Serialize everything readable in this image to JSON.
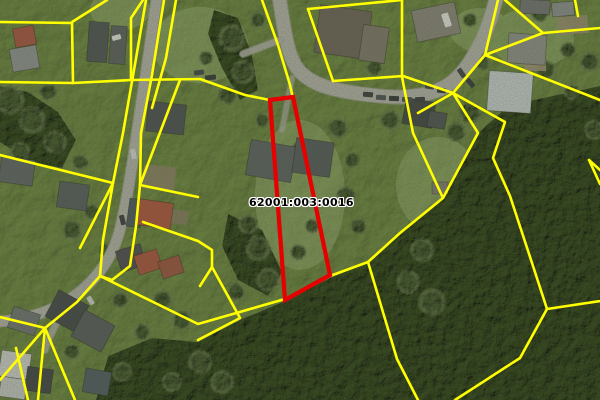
{
  "map": {
    "kind": "aerial-orthophoto-with-cadastral-overlay",
    "parcel_label": "62001:003:0016",
    "label_pos": {
      "x": 249,
      "y": 196
    },
    "colors": {
      "boundary_line": "#ffff00",
      "selected_parcel_outline": "#e60000",
      "label_text": "#000000",
      "label_halo": "#ffffff",
      "grass": "#8aa365",
      "grass_light": "#a3bb7c",
      "forest": "#4d6039",
      "road": "#b5b3ac",
      "road_edge": "#a19f98"
    },
    "selected_parcel_outline": [
      [
        270,
        100
      ],
      [
        293,
        97
      ],
      [
        330,
        275
      ],
      [
        285,
        300
      ]
    ],
    "selected_parcel_stroke_width": 4.2,
    "boundary_line_width": 2.6,
    "boundary_lines": [
      [
        [
          0,
          22
        ],
        [
          72,
          23
        ]
      ],
      [
        [
          107,
          0
        ],
        [
          72,
          22
        ]
      ],
      [
        [
          72,
          23
        ],
        [
          73,
          83
        ]
      ],
      [
        [
          0,
          82
        ],
        [
          73,
          83
        ],
        [
          131,
          80
        ],
        [
          200,
          79
        ],
        [
          245,
          95
        ],
        [
          270,
          100
        ]
      ],
      [
        [
          143,
          0
        ],
        [
          131,
          18
        ],
        [
          131,
          80
        ]
      ],
      [
        [
          164,
          0
        ],
        [
          152,
          75
        ],
        [
          141,
          133
        ],
        [
          140,
          185
        ]
      ],
      [
        [
          176,
          0
        ],
        [
          166,
          58
        ],
        [
          152,
          108
        ]
      ],
      [
        [
          262,
          0
        ],
        [
          278,
          45
        ],
        [
          290,
          85
        ],
        [
          293,
          98
        ]
      ],
      [
        [
          308,
          9
        ],
        [
          333,
          81
        ]
      ],
      [
        [
          308,
          9
        ],
        [
          402,
          0
        ]
      ],
      [
        [
          402,
          0
        ],
        [
          402,
          77
        ],
        [
          413,
          133
        ],
        [
          443,
          198
        ]
      ],
      [
        [
          333,
          81
        ],
        [
          403,
          76
        ],
        [
          453,
          93
        ]
      ],
      [
        [
          418,
          113
        ],
        [
          453,
          93
        ]
      ],
      [
        [
          453,
          93
        ],
        [
          485,
          55
        ],
        [
          498,
          0
        ]
      ],
      [
        [
          485,
          55
        ],
        [
          543,
          33
        ],
        [
          600,
          28
        ]
      ],
      [
        [
          505,
          0
        ],
        [
          543,
          33
        ]
      ],
      [
        [
          575,
          0
        ],
        [
          578,
          16
        ]
      ],
      [
        [
          485,
          55
        ],
        [
          600,
          100
        ]
      ],
      [
        [
          453,
          93
        ],
        [
          478,
          133
        ],
        [
          443,
          198
        ],
        [
          400,
          233
        ],
        [
          368,
          262
        ],
        [
          397,
          359
        ],
        [
          418,
          400
        ]
      ],
      [
        [
          453,
          93
        ],
        [
          505,
          122
        ],
        [
          493,
          158
        ],
        [
          510,
          196
        ],
        [
          533,
          266
        ],
        [
          547,
          309
        ]
      ],
      [
        [
          547,
          309
        ],
        [
          600,
          301
        ]
      ],
      [
        [
          547,
          309
        ],
        [
          520,
          358
        ],
        [
          455,
          400
        ]
      ],
      [
        [
          600,
          170
        ],
        [
          589,
          160
        ],
        [
          600,
          184
        ]
      ],
      [
        [
          140,
          185
        ],
        [
          180,
          80
        ]
      ],
      [
        [
          140,
          185
        ],
        [
          198,
          197
        ]
      ],
      [
        [
          143,
          222
        ],
        [
          198,
          241
        ],
        [
          212,
          250
        ],
        [
          212,
          267
        ]
      ],
      [
        [
          140,
          185
        ],
        [
          136,
          226
        ],
        [
          130,
          266
        ],
        [
          112,
          280
        ],
        [
          100,
          276
        ]
      ],
      [
        [
          113,
          183
        ],
        [
          0,
          155
        ]
      ],
      [
        [
          113,
          183
        ],
        [
          80,
          248
        ]
      ],
      [
        [
          146,
          0
        ],
        [
          134,
          70
        ],
        [
          123,
          133
        ],
        [
          113,
          183
        ],
        [
          103,
          240
        ],
        [
          100,
          276
        ]
      ],
      [
        [
          100,
          276
        ],
        [
          198,
          324
        ],
        [
          285,
          299
        ],
        [
          330,
          276
        ],
        [
          368,
          262
        ]
      ],
      [
        [
          212,
          267
        ],
        [
          240,
          318
        ],
        [
          198,
          340
        ]
      ],
      [
        [
          212,
          267
        ],
        [
          200,
          286
        ]
      ],
      [
        [
          45,
          328
        ],
        [
          0,
          317
        ]
      ],
      [
        [
          45,
          328
        ],
        [
          0,
          380
        ]
      ],
      [
        [
          45,
          328
        ],
        [
          38,
          400
        ]
      ],
      [
        [
          45,
          328
        ],
        [
          75,
          400
        ]
      ],
      [
        [
          45,
          328
        ],
        [
          77,
          302
        ],
        [
          100,
          276
        ]
      ],
      [
        [
          16,
          348
        ],
        [
          28,
          400
        ]
      ]
    ],
    "roads": [
      {
        "d": "M279,-4 C284,28 287,54 297,68 C310,85 332,90 362,94 C385,97 400,98 413,96 C447,93 463,77 479,46 C487,31 492,15 497,-4",
        "width": 13,
        "opacity": 1
      },
      {
        "d": "M157,-4 C151,40 145,80 139,118 C133,158 128,198 119,233 C111,261 92,287 62,304 C42,315 20,320 -4,322",
        "width": 10,
        "opacity": 1
      },
      {
        "d": "M88,282 C70,300 56,318 45,350",
        "width": 6,
        "opacity": 0.7
      },
      {
        "d": "M280,40 L243,54",
        "width": 6,
        "opacity": 0.8
      },
      {
        "d": "M292,78 L282,130",
        "width": 5,
        "opacity": 0.55
      }
    ],
    "forest_areas": [
      [
        [
          600,
          86
        ],
        [
          552,
          96
        ],
        [
          508,
          106
        ],
        [
          478,
          133
        ],
        [
          443,
          198
        ],
        [
          400,
          233
        ],
        [
          368,
          262
        ],
        [
          330,
          278
        ],
        [
          285,
          301
        ],
        [
          240,
          320
        ],
        [
          198,
          342
        ],
        [
          152,
          338
        ],
        [
          108,
          356
        ],
        [
          96,
          400
        ],
        [
          600,
          400
        ]
      ],
      [
        [
          0,
          86
        ],
        [
          28,
          92
        ],
        [
          58,
          112
        ],
        [
          76,
          140
        ],
        [
          62,
          168
        ],
        [
          30,
          162
        ],
        [
          0,
          142
        ]
      ],
      [
        [
          214,
          10
        ],
        [
          238,
          18
        ],
        [
          252,
          55
        ],
        [
          258,
          90
        ],
        [
          240,
          100
        ],
        [
          222,
          68
        ],
        [
          208,
          34
        ]
      ],
      [
        [
          228,
          214
        ],
        [
          262,
          230
        ],
        [
          282,
          272
        ],
        [
          268,
          296
        ],
        [
          238,
          280
        ],
        [
          222,
          246
        ]
      ]
    ],
    "tree_clumps": [
      [
        232,
        38,
        15
      ],
      [
        243,
        72,
        13
      ],
      [
        228,
        95,
        11
      ],
      [
        258,
        20,
        9
      ],
      [
        206,
        58,
        8
      ],
      [
        10,
        100,
        16
      ],
      [
        32,
        120,
        15
      ],
      [
        55,
        142,
        13
      ],
      [
        20,
        152,
        11
      ],
      [
        48,
        92,
        10
      ],
      [
        80,
        162,
        9
      ],
      [
        72,
        230,
        11
      ],
      [
        92,
        212,
        9
      ],
      [
        105,
        250,
        8
      ],
      [
        258,
        248,
        14
      ],
      [
        268,
        280,
        13
      ],
      [
        248,
        224,
        11
      ],
      [
        298,
        252,
        9
      ],
      [
        312,
        226,
        8
      ],
      [
        298,
        150,
        9
      ],
      [
        338,
        128,
        11
      ],
      [
        352,
        160,
        9
      ],
      [
        346,
        196,
        11
      ],
      [
        358,
        226,
        9
      ],
      [
        390,
        120,
        11
      ],
      [
        374,
        68,
        9
      ],
      [
        302,
        70,
        7
      ],
      [
        262,
        120,
        8
      ],
      [
        470,
        112,
        13
      ],
      [
        456,
        132,
        11
      ],
      [
        482,
        62,
        9
      ],
      [
        546,
        70,
        11
      ],
      [
        568,
        50,
        9
      ],
      [
        590,
        62,
        11
      ],
      [
        540,
        14,
        9
      ],
      [
        572,
        92,
        9
      ],
      [
        594,
        130,
        11
      ],
      [
        470,
        20,
        8
      ],
      [
        422,
        250,
        13
      ],
      [
        408,
        282,
        13
      ],
      [
        432,
        302,
        15
      ],
      [
        162,
        300,
        11
      ],
      [
        182,
        320,
        11
      ],
      [
        142,
        332,
        9
      ],
      [
        200,
        362,
        13
      ],
      [
        172,
        382,
        11
      ],
      [
        122,
        372,
        11
      ],
      [
        222,
        382,
        13
      ],
      [
        102,
        332,
        9
      ],
      [
        72,
        352,
        9
      ],
      [
        92,
        386,
        9
      ],
      [
        120,
        300,
        9
      ],
      [
        236,
        292,
        10
      ]
    ],
    "lawn_patches": [
      [
        200,
        45,
        48,
        38
      ],
      [
        300,
        195,
        45,
        75
      ],
      [
        438,
        185,
        42,
        48
      ],
      [
        532,
        38,
        42,
        30
      ],
      [
        120,
        10,
        30,
        20
      ],
      [
        480,
        30,
        30,
        22
      ]
    ],
    "soil_patches": [
      [
        143,
        166,
        32,
        24,
        5,
        "#8d8066"
      ],
      [
        558,
        16,
        30,
        18,
        -4,
        "#9a8c70"
      ],
      [
        524,
        58,
        22,
        13,
        0,
        "#a29176"
      ],
      [
        168,
        210,
        20,
        14,
        8,
        "#86795f"
      ]
    ],
    "houses": [
      [
        14,
        27,
        21,
        19,
        -10,
        "#a94f3e"
      ],
      [
        11,
        47,
        27,
        23,
        -10,
        "#8f9193"
      ],
      [
        88,
        22,
        20,
        40,
        4,
        "#4a4e52"
      ],
      [
        110,
        26,
        16,
        38,
        4,
        "#585b5e"
      ],
      [
        147,
        103,
        38,
        30,
        6,
        "#474b4f"
      ],
      [
        248,
        143,
        46,
        36,
        10,
        "#585d60"
      ],
      [
        294,
        140,
        38,
        35,
        8,
        "#515559"
      ],
      [
        317,
        8,
        52,
        48,
        8,
        "#6b6057"
      ],
      [
        361,
        26,
        26,
        36,
        8,
        "#7d746a"
      ],
      [
        414,
        6,
        44,
        32,
        -12,
        "#89837b"
      ],
      [
        520,
        0,
        30,
        14,
        3,
        "#6f7072"
      ],
      [
        552,
        2,
        22,
        14,
        -5,
        "#8a8d8f"
      ],
      [
        508,
        34,
        38,
        30,
        4,
        "#8e8e8a"
      ],
      [
        488,
        72,
        44,
        40,
        4,
        "#c9d0d4"
      ],
      [
        0,
        158,
        34,
        26,
        8,
        "#5d6164"
      ],
      [
        58,
        183,
        30,
        26,
        8,
        "#54585c"
      ],
      [
        128,
        199,
        14,
        28,
        8,
        "#46525e"
      ],
      [
        138,
        201,
        34,
        26,
        8,
        "#b0503a"
      ],
      [
        118,
        247,
        26,
        22,
        -18,
        "#4a4550"
      ],
      [
        136,
        252,
        24,
        20,
        -18,
        "#ab4f3a"
      ],
      [
        160,
        258,
        22,
        18,
        -18,
        "#9c4f3c"
      ],
      [
        50,
        296,
        34,
        30,
        28,
        "#3f4246"
      ],
      [
        76,
        316,
        34,
        30,
        28,
        "#53565a"
      ],
      [
        10,
        310,
        28,
        22,
        18,
        "#6d7072"
      ],
      [
        0,
        352,
        30,
        26,
        8,
        "#d3d3d1"
      ],
      [
        0,
        378,
        26,
        20,
        8,
        "#c7c9c9"
      ],
      [
        26,
        368,
        26,
        24,
        8,
        "#3c3f43"
      ],
      [
        84,
        370,
        26,
        24,
        10,
        "#4c5661"
      ],
      [
        404,
        100,
        30,
        26,
        10,
        "#3b3e42"
      ],
      [
        428,
        112,
        18,
        16,
        10,
        "#4a4d51"
      ],
      [
        432,
        182,
        16,
        12,
        0,
        "#7e7a72"
      ]
    ],
    "vehicles": [
      [
        363,
        92,
        10,
        5,
        4,
        "#33363a"
      ],
      [
        376,
        95,
        10,
        5,
        3,
        "#4a4e52"
      ],
      [
        389,
        96,
        10,
        5,
        2,
        "#2c2f33"
      ],
      [
        402,
        97,
        10,
        5,
        1,
        "#43474b"
      ],
      [
        415,
        97,
        10,
        5,
        -2,
        "#35383c"
      ],
      [
        425,
        84,
        9,
        5,
        8,
        "#3a3d41"
      ],
      [
        437,
        88,
        9,
        5,
        6,
        "#2f3236"
      ],
      [
        459,
        68,
        5,
        10,
        -35,
        "#3a3d41"
      ],
      [
        468,
        78,
        5,
        10,
        -40,
        "#2f3236"
      ],
      [
        443,
        13,
        7,
        14,
        -18,
        "#e9e9e7"
      ],
      [
        205,
        75,
        11,
        5,
        -6,
        "#2e3135"
      ],
      [
        194,
        70,
        10,
        5,
        -8,
        "#3c4044"
      ],
      [
        112,
        35,
        9,
        5,
        -15,
        "#e8e8e8"
      ],
      [
        131,
        149,
        5,
        10,
        -12,
        "#d9d9d7"
      ],
      [
        120,
        215,
        5,
        10,
        -14,
        "#33363a"
      ],
      [
        88,
        296,
        5,
        9,
        -30,
        "#d0d0ce"
      ]
    ]
  }
}
